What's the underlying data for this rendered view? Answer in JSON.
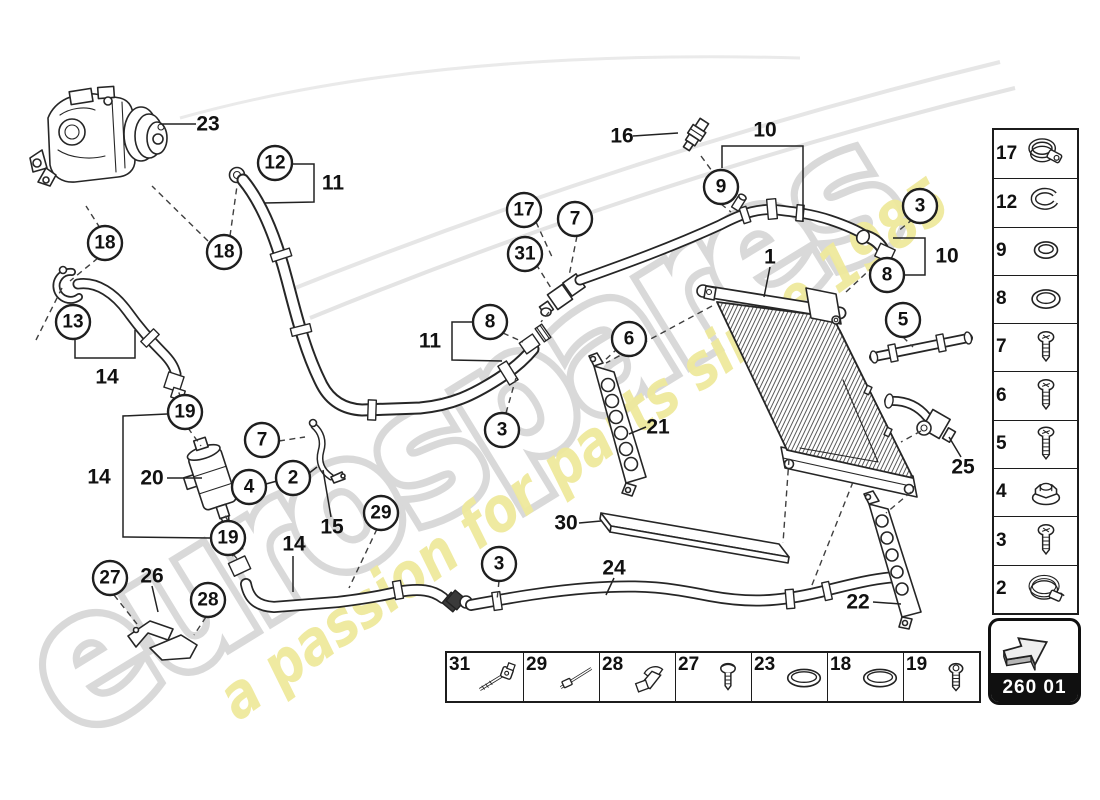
{
  "watermark": {
    "brand": "eurospares",
    "tagline": "a passion for parts since 1985",
    "brand_color": "#ffffff",
    "brand_outline": "#d9d9d9",
    "tagline_color": "#efe99c"
  },
  "page_code": {
    "label": "260 01"
  },
  "sidebar": {
    "items": [
      {
        "number": "17",
        "icon": "pipe-clamp"
      },
      {
        "number": "12",
        "icon": "snap-ring"
      },
      {
        "number": "9",
        "icon": "o-ring-small"
      },
      {
        "number": "8",
        "icon": "o-ring"
      },
      {
        "number": "7",
        "icon": "screw"
      },
      {
        "number": "6",
        "icon": "screw"
      },
      {
        "number": "5",
        "icon": "screw-long"
      },
      {
        "number": "4",
        "icon": "flange-nut"
      },
      {
        "number": "3",
        "icon": "screw"
      },
      {
        "number": "2",
        "icon": "hose-clamp"
      }
    ]
  },
  "bottom_strip": {
    "items": [
      {
        "number": "31",
        "icon": "cable-tie-mount"
      },
      {
        "number": "29",
        "icon": "cable-tie"
      },
      {
        "number": "28",
        "icon": "cable-clip"
      },
      {
        "number": "27",
        "icon": "pan-screw"
      },
      {
        "number": "23",
        "icon": "o-ring-wide"
      },
      {
        "number": "18",
        "icon": "o-ring-wide"
      },
      {
        "number": "19",
        "icon": "socket-bolt"
      }
    ]
  },
  "callouts": {
    "circled": [
      {
        "n": "18",
        "x": 105,
        "y": 243
      },
      {
        "n": "18",
        "x": 224,
        "y": 252
      },
      {
        "n": "12",
        "x": 275,
        "y": 163
      },
      {
        "n": "13",
        "x": 73,
        "y": 322
      },
      {
        "n": "19",
        "x": 185,
        "y": 412
      },
      {
        "n": "19",
        "x": 228,
        "y": 538
      },
      {
        "n": "7",
        "x": 262,
        "y": 440
      },
      {
        "n": "4",
        "x": 249,
        "y": 487
      },
      {
        "n": "2",
        "x": 293,
        "y": 478
      },
      {
        "n": "27",
        "x": 110,
        "y": 578
      },
      {
        "n": "28",
        "x": 208,
        "y": 600
      },
      {
        "n": "29",
        "x": 381,
        "y": 513
      },
      {
        "n": "3",
        "x": 499,
        "y": 564
      },
      {
        "n": "3",
        "x": 502,
        "y": 430
      },
      {
        "n": "8",
        "x": 490,
        "y": 322
      },
      {
        "n": "17",
        "x": 524,
        "y": 210
      },
      {
        "n": "7",
        "x": 575,
        "y": 219
      },
      {
        "n": "31",
        "x": 525,
        "y": 254
      },
      {
        "n": "6",
        "x": 629,
        "y": 339
      },
      {
        "n": "9",
        "x": 721,
        "y": 187
      },
      {
        "n": "3",
        "x": 920,
        "y": 206
      },
      {
        "n": "8",
        "x": 887,
        "y": 275
      },
      {
        "n": "5",
        "x": 903,
        "y": 320
      }
    ],
    "plain": [
      {
        "n": "23",
        "x": 208,
        "y": 124
      },
      {
        "n": "11",
        "x": 333,
        "y": 183
      },
      {
        "n": "16",
        "x": 622,
        "y": 136
      },
      {
        "n": "10",
        "x": 765,
        "y": 130
      },
      {
        "n": "1",
        "x": 770,
        "y": 257
      },
      {
        "n": "10",
        "x": 947,
        "y": 256
      },
      {
        "n": "11",
        "x": 430,
        "y": 341
      },
      {
        "n": "14",
        "x": 107,
        "y": 377
      },
      {
        "n": "14",
        "x": 99,
        "y": 477
      },
      {
        "n": "20",
        "x": 152,
        "y": 478
      },
      {
        "n": "15",
        "x": 332,
        "y": 527
      },
      {
        "n": "14",
        "x": 294,
        "y": 544
      },
      {
        "n": "26",
        "x": 152,
        "y": 576
      },
      {
        "n": "21",
        "x": 658,
        "y": 427
      },
      {
        "n": "30",
        "x": 566,
        "y": 523
      },
      {
        "n": "24",
        "x": 614,
        "y": 568
      },
      {
        "n": "22",
        "x": 858,
        "y": 602
      },
      {
        "n": "25",
        "x": 963,
        "y": 467
      }
    ]
  }
}
